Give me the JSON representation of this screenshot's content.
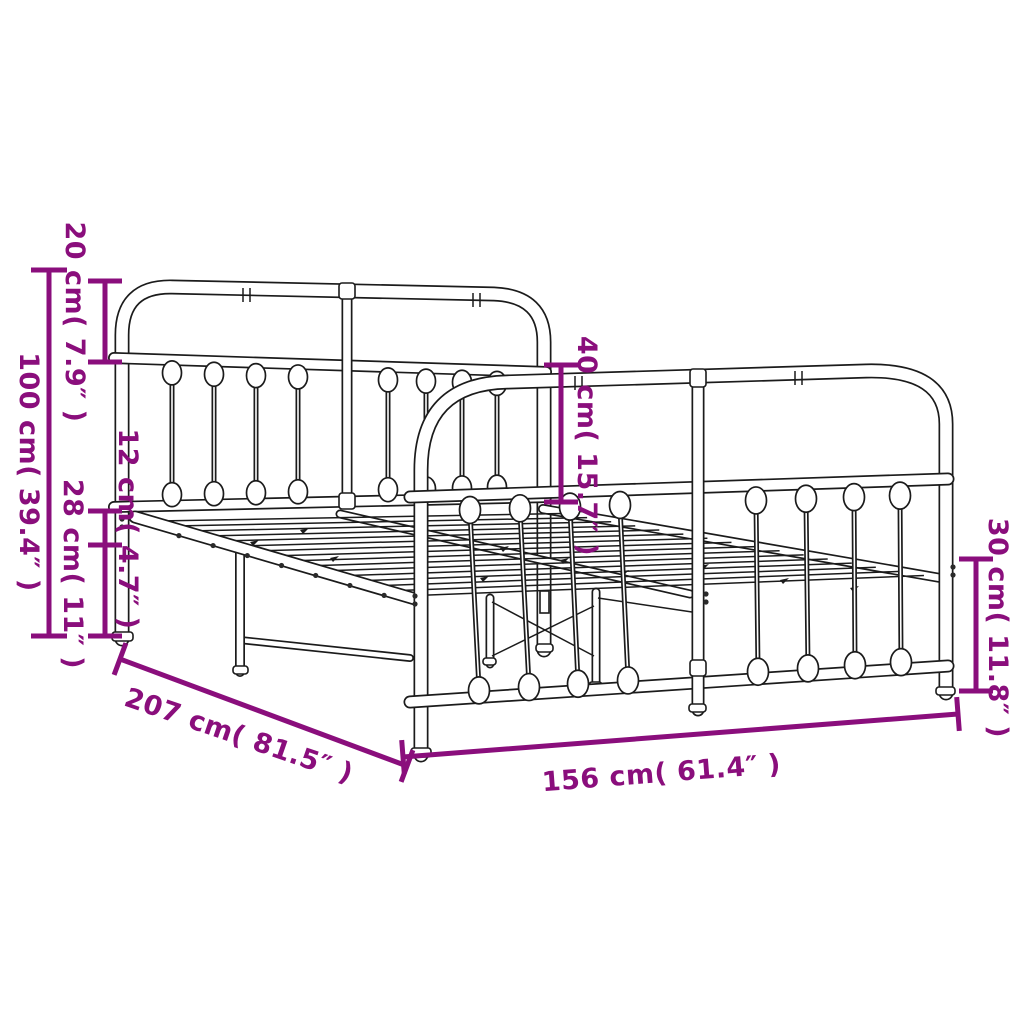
{
  "page": {
    "background": "#ffffff",
    "subject": "Metal bed frame with headboard and footboard — product dimension diagram"
  },
  "colors": {
    "accent": "#8a0e7c",
    "line": "#1b1b1b",
    "background": "#ffffff"
  },
  "dimensions": {
    "overall_height": {
      "label": "100 cm( 39.4″ )",
      "cm": 100,
      "inches": 39.4
    },
    "headboard_top_section": {
      "label": "20 cm( 7.9″ )",
      "cm": 20,
      "inches": 7.9
    },
    "frame_depth": {
      "label": "12 cm( 4.7″ )",
      "cm": 12,
      "inches": 4.7
    },
    "underbed_clearance": {
      "label": "28 cm( 11″ )",
      "cm": 28,
      "inches": 11
    },
    "headboard_to_base": {
      "label": "40 cm( 15.7″ )",
      "cm": 40,
      "inches": 15.7
    },
    "footboard_height": {
      "label": "30 cm( 11.8″ )",
      "cm": 30,
      "inches": 11.8
    },
    "length": {
      "label": "207 cm( 81.5″ )",
      "cm": 207,
      "inches": 81.5
    },
    "width": {
      "label": "156 cm( 61.4″ )",
      "cm": 156,
      "inches": 61.4
    }
  }
}
